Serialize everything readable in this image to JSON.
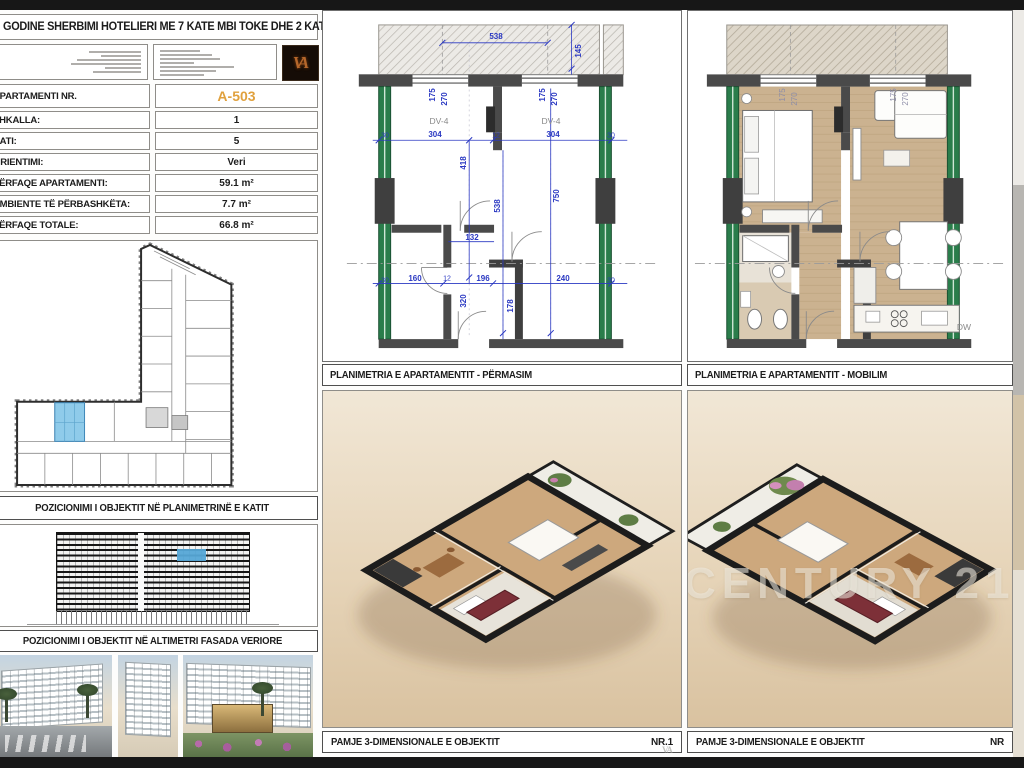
{
  "title_block": {
    "project_title": "GODINE SHERBIMI HOTELIERI ME 7 KATE MBI TOKE DHE 2 KATE NENTOKE",
    "logo_monogram": "VA"
  },
  "apartment_table": {
    "rows": [
      {
        "label": "APARTAMENTI NR.",
        "value": "A-503",
        "highlight": true
      },
      {
        "label": "SHKALLA:",
        "value": "1"
      },
      {
        "label": "KATI:",
        "value": "5"
      },
      {
        "label": "ORIENTIMI:",
        "value": "Veri"
      },
      {
        "label": "PËRFAQE APARTAMENTI:",
        "value": "59.1 m²"
      },
      {
        "label": "AMBIENTE TË PËRBASHKËTA:",
        "value": "7.7 m²"
      },
      {
        "label": "PËRFAQE TOTALE:",
        "value": "66.8 m²"
      }
    ]
  },
  "panels": {
    "key_plan_caption": "POZICIONIMI I OBJEKTIT NË PLANIMETRINË E KATIT",
    "elevation_caption": "POZICIONIMI I OBJEKTIT NË ALTIMETRI FASADA  VERIORE",
    "plan_dim_caption": "PLANIMETRIA E APARTAMENTIT - PËRMASIM",
    "plan_furn_caption": "PLANIMETRIA E APARTAMENTIT - MOBILIM",
    "view3d_left_caption": "PAMJE 3-DIMENSIONALE E OBJEKTIT",
    "view3d_left_nr": "NR.1",
    "view3d_right_caption": "PAMJE 3-DIMENSIONALE E OBJEKTIT",
    "view3d_right_nr": "NR",
    "watermark": "CENTURY 21"
  },
  "plan_dim": {
    "labels": [
      {
        "t": "538",
        "x": 173,
        "y": 26,
        "r": 0
      },
      {
        "t": "145",
        "x": 256,
        "y": 40,
        "r": -90
      },
      {
        "t": "175",
        "x": 110,
        "y": 84,
        "r": -90
      },
      {
        "t": "270",
        "x": 122,
        "y": 88,
        "r": -90
      },
      {
        "t": "175",
        "x": 220,
        "y": 84,
        "r": -90
      },
      {
        "t": "270",
        "x": 232,
        "y": 88,
        "r": -90
      },
      {
        "t": "DV-4",
        "x": 116,
        "y": 110,
        "r": 0,
        "k": "tag"
      },
      {
        "t": "DV-4",
        "x": 228,
        "y": 110,
        "r": 0,
        "k": "tag"
      },
      {
        "t": "30",
        "x": 62,
        "y": 125,
        "r": 0,
        "k": "sm"
      },
      {
        "t": "304",
        "x": 112,
        "y": 124,
        "r": 0
      },
      {
        "t": "12",
        "x": 173,
        "y": 125,
        "r": 0,
        "k": "sm"
      },
      {
        "t": "304",
        "x": 230,
        "y": 124,
        "r": 0
      },
      {
        "t": "30",
        "x": 288,
        "y": 125,
        "r": 0,
        "k": "sm"
      },
      {
        "t": "418",
        "x": 141,
        "y": 152,
        "r": -90
      },
      {
        "t": "538",
        "x": 175,
        "y": 195,
        "r": -90
      },
      {
        "t": "750",
        "x": 234,
        "y": 185,
        "r": -90
      },
      {
        "t": "132",
        "x": 149,
        "y": 227,
        "r": 0
      },
      {
        "t": "160",
        "x": 92,
        "y": 268,
        "r": 0
      },
      {
        "t": "12",
        "x": 124,
        "y": 268,
        "r": 0,
        "k": "sm"
      },
      {
        "t": "196",
        "x": 160,
        "y": 268,
        "r": 0
      },
      {
        "t": "240",
        "x": 240,
        "y": 268,
        "r": 0
      },
      {
        "t": "30",
        "x": 62,
        "y": 270,
        "r": 0,
        "k": "sm"
      },
      {
        "t": "30",
        "x": 288,
        "y": 270,
        "r": 0,
        "k": "sm"
      },
      {
        "t": "320",
        "x": 141,
        "y": 290,
        "r": -90
      },
      {
        "t": "178",
        "x": 188,
        "y": 295,
        "r": -90
      }
    ]
  },
  "plan_furn": {
    "labels": [
      {
        "t": "175",
        "x": 95,
        "y": 84,
        "r": -90,
        "k": "furn"
      },
      {
        "t": "270",
        "x": 107,
        "y": 88,
        "r": -90,
        "k": "furn"
      },
      {
        "t": "175",
        "x": 206,
        "y": 84,
        "r": -90,
        "k": "furn"
      },
      {
        "t": "270",
        "x": 218,
        "y": 88,
        "r": -90,
        "k": "furn"
      },
      {
        "t": "DW",
        "x": 276,
        "y": 316,
        "r": 0,
        "k": "tag"
      }
    ]
  },
  "colors": {
    "accent_orange": "#e0a13e",
    "dimension_blue": "#2a38c2",
    "column_green": "#2a7d4b",
    "unit_highlight_blue": "#8fcbea",
    "render_beige": "#e6d4b8",
    "sofa_red": "#7d3038"
  }
}
